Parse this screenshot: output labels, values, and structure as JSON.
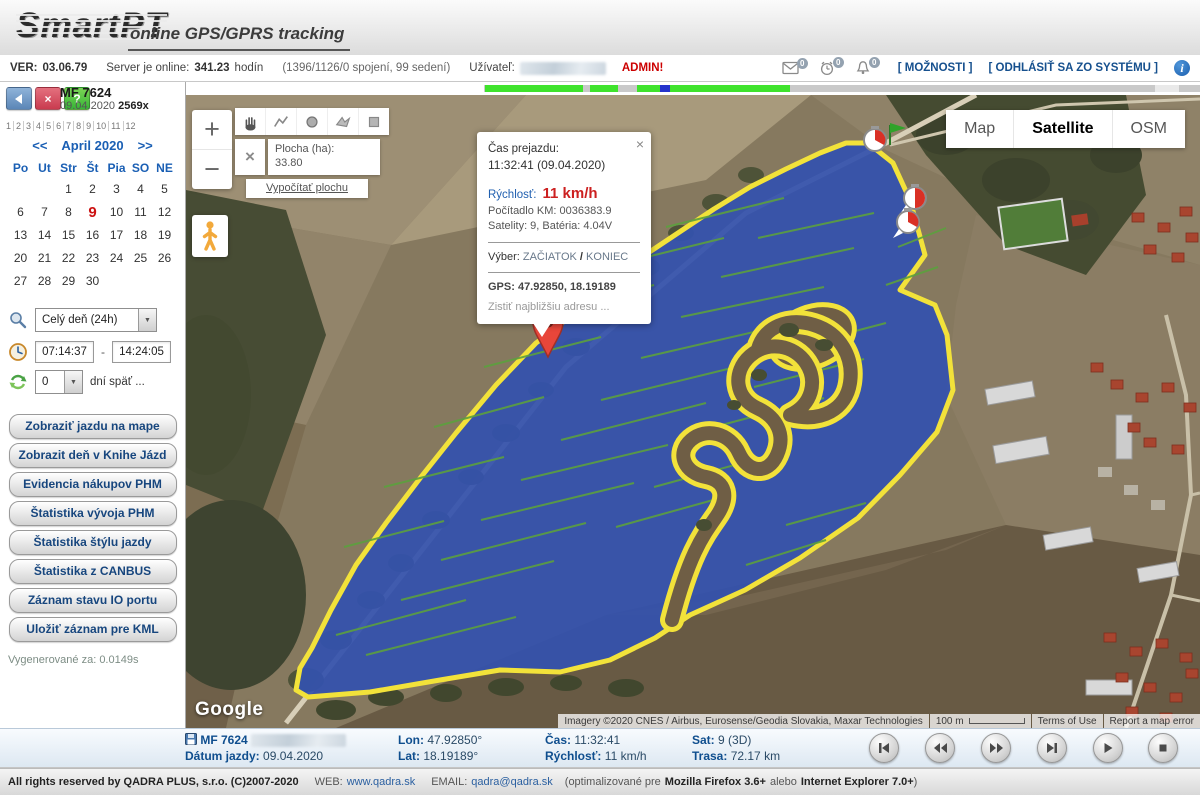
{
  "colors": {
    "accent_navy": "#104e8c",
    "admin_red": "#cc0000",
    "track_yellow": "#f2e23a",
    "area_blue": "#3452ad",
    "timeline_green": "#3fe32c",
    "timeline_position": "#2433cc",
    "calendar_blue": "#1a5fb4",
    "today_red": "#cc1111"
  },
  "header": {
    "logo": "SmartPT",
    "tagline": "online GPS/GPRS tracking"
  },
  "statusbar": {
    "ver_label": "VER:",
    "ver_value": "03.06.79",
    "server_label": "Server je online:",
    "server_hours": "341.23",
    "server_unit": "hodín",
    "connections": "(1396/1126/0 spojení, 99 sedení)",
    "user_label": "Užívateľ:",
    "admin_badge": "ADMIN!",
    "mail_count": "0",
    "timer_count": "0",
    "bell_count": "0",
    "options_link": "[ MOŽNOSTI ]",
    "logout_link": "[ ODHLÁSIŤ SA ZO SYSTÉMU ]",
    "info_icon_glyph": "i"
  },
  "sidebar": {
    "back_button": "",
    "close_button": "×",
    "help_button": "?",
    "device_name": "MF 7624",
    "device_date": "09.04.2020",
    "device_count": "2569x",
    "months": [
      "1",
      "2",
      "3",
      "4",
      "5",
      "6",
      "7",
      "8",
      "9",
      "10",
      "11",
      "12"
    ],
    "calendar": {
      "prev": "<<",
      "title": "April 2020",
      "next": ">>",
      "day_headers": [
        "Po",
        "Ut",
        "Str",
        "Št",
        "Pia",
        "SO",
        "NE"
      ],
      "weeks": [
        [
          "",
          "",
          "1",
          "2",
          "3",
          "4",
          "5"
        ],
        [
          "6",
          "7",
          "8",
          "9",
          "10",
          "11",
          "12"
        ],
        [
          "13",
          "14",
          "15",
          "16",
          "17",
          "18",
          "19"
        ],
        [
          "20",
          "21",
          "22",
          "23",
          "24",
          "25",
          "26"
        ],
        [
          "27",
          "28",
          "29",
          "30",
          "",
          "",
          ""
        ]
      ]
    },
    "range_value": "Celý deň (24h)",
    "time_from": "07:14:37",
    "time_dash": "-",
    "time_to": "14:24:05",
    "days_back_value": "0",
    "days_back_label": "dní späť ...",
    "buttons": [
      "Zobraziť jazdu na mape",
      "Zobrazit deň v Knihe Jázd",
      "Evidencia nákupov PHM",
      "Štatistika vývoja PHM",
      "Štatistika štýlu jazdy",
      "Štatistika z CANBUS",
      "Záznam stavu IO portu",
      "Uložiť záznam pre KML"
    ],
    "generated": "Vygenerované za: 0.0149s"
  },
  "map": {
    "zoom_in": "+",
    "zoom_out": "−",
    "area_close": "×",
    "area_label": "Plocha (ha):",
    "area_value": "33.80",
    "compute_area_link": "Vypočítať plochu",
    "type_map": "Map",
    "type_satellite": "Satellite",
    "type_osm": "OSM",
    "popup": {
      "close": "×",
      "title": "Čas prejazdu:",
      "datetime": "11:32:41 (09.04.2020)",
      "speed_label": "Rýchlosť:",
      "speed_value": "11 km/h",
      "odometer": "Počítadlo KM: 0036383.9",
      "satellites": "Satelity: 9, Batéria: 4.04V",
      "select_label": "Výber:",
      "select_start": "ZAČIATOK",
      "select_sep": "/",
      "select_end": "KONIEC",
      "gps": "GPS: 47.92850, 18.19189",
      "address_link": "Zistiť najbližšiu adresu ..."
    },
    "google_logo": "Google",
    "attribution": "Imagery ©2020 CNES / Airbus, Eurosense/Geodia Slovakia, Maxar Technologies",
    "scale_label": "100 m",
    "terms_link": "Terms of Use",
    "report_link": "Report a map error"
  },
  "bottombar": {
    "device_name": "MF 7624",
    "date_label": "Dátum jazdy:",
    "date_value": "09.04.2020",
    "lon_label": "Lon:",
    "lon_value": "47.92850°",
    "lat_label": "Lat:",
    "lat_value": "18.19189°",
    "time_label": "Čas:",
    "time_value": "11:32:41",
    "speed_label": "Rýchlosť:",
    "speed_value": "11 km/h",
    "sat_label": "Sat:",
    "sat_value": "9 (3D)",
    "dist_label": "Trasa:",
    "dist_value": "72.17 km"
  },
  "footer": {
    "rights": "All rights reserved by QADRA PLUS, s.r.o. (C)2007-2020",
    "web_label": "WEB:",
    "web_link": "www.qadra.sk",
    "email_label": "EMAIL:",
    "email_link": "qadra@qadra.sk",
    "opt_prefix": "(optimalizované pre",
    "firefox": "Mozilla Firefox 3.6+",
    "opt_mid": "alebo",
    "ie": "Internet Explorer 7.0+",
    "opt_suffix": ")"
  }
}
